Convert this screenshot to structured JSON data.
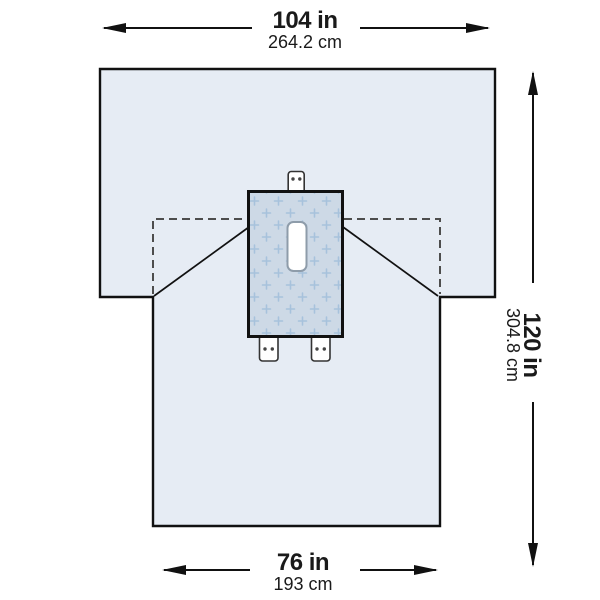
{
  "colors": {
    "drape_fill": "#e6ecf4",
    "panel_fill": "#cdd9e6",
    "plus_marks": "#a7c2dc",
    "fenestration_fill": "#ffffff",
    "fenestration_border": "#8e9caa",
    "tab_fill": "#ffffff",
    "outline": "#111111",
    "fold_line": "#4d4d4d",
    "text": "#1a1a1a"
  },
  "dimensions": {
    "top": {
      "imperial": "104 in",
      "metric": "264.2 cm"
    },
    "right": {
      "imperial": "120 in",
      "metric": "304.8 cm"
    },
    "bottom": {
      "imperial": "76 in",
      "metric": "193 cm"
    }
  }
}
